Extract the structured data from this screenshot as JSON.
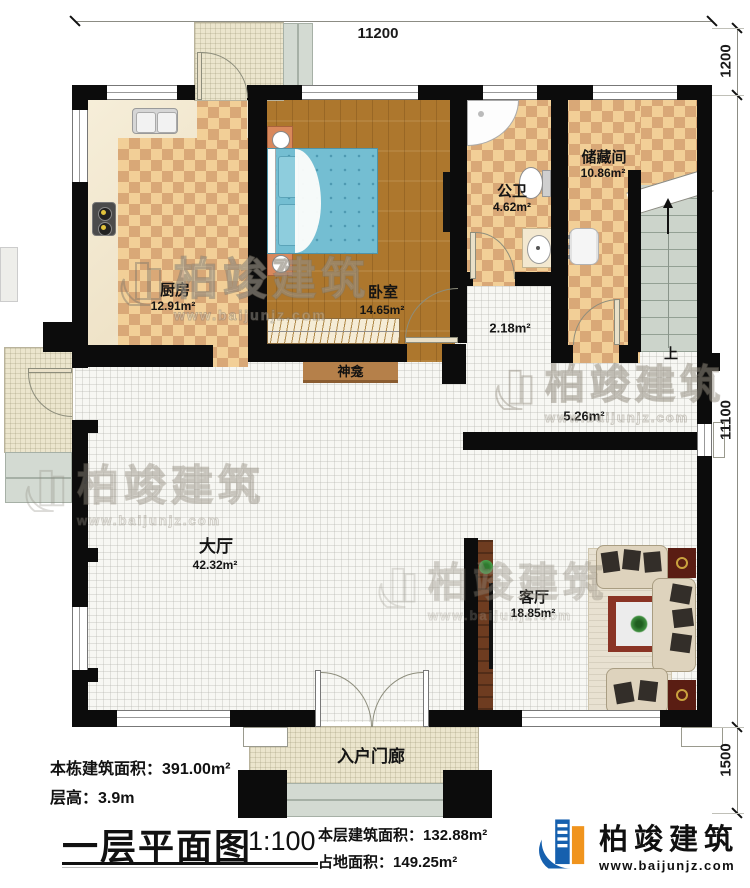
{
  "dimensions": {
    "top": "11200",
    "right_top": "1200",
    "right_middle": "11100",
    "right_bottom": "1500"
  },
  "rooms": {
    "kitchen": {
      "name": "厨房",
      "area": "12.91m²"
    },
    "bedroom": {
      "name": "卧室",
      "area": "14.65m²"
    },
    "bathroom": {
      "name": "公卫",
      "area": "4.62m²"
    },
    "storage": {
      "name": "储藏间",
      "area": "10.86m²"
    },
    "corridor": {
      "area": "2.18m²"
    },
    "stair_hall": {
      "area": "5.26m²"
    },
    "hall": {
      "name": "大厅",
      "area": "42.32m²"
    },
    "living": {
      "name": "客厅",
      "area": "18.85m²"
    },
    "shrine": {
      "name": "神龛"
    },
    "entry_porch": {
      "name": "入户门廊"
    },
    "stairs": {
      "up_label": "上"
    }
  },
  "title_block": {
    "total_area_label": "本栋建筑面积：",
    "total_area_value": "391.00m²",
    "floor_height_label": "层高：",
    "floor_height_value": "3.9m",
    "plan_title": "一层平面图",
    "plan_scale": "1:100",
    "floor_area_label": "本层建筑面积：",
    "floor_area_value": "132.88m²",
    "footprint_label": "占地面积：",
    "footprint_value": "149.25m²"
  },
  "brand": {
    "name": "柏竣建筑",
    "url": "www.baijunjz.com"
  },
  "watermark": {
    "name": "柏竣建筑",
    "url": "www.baijunjz.com"
  },
  "colors": {
    "wall": "#0c0c0c",
    "checker_dark": "#d9a877",
    "checker_light": "#f2cf97",
    "wood": "#ad772d",
    "brand_blue": "#1660ae",
    "brand_orange": "#f0941d",
    "bed_blue": "#74bed2",
    "stair_green": "#ccd4cb"
  }
}
